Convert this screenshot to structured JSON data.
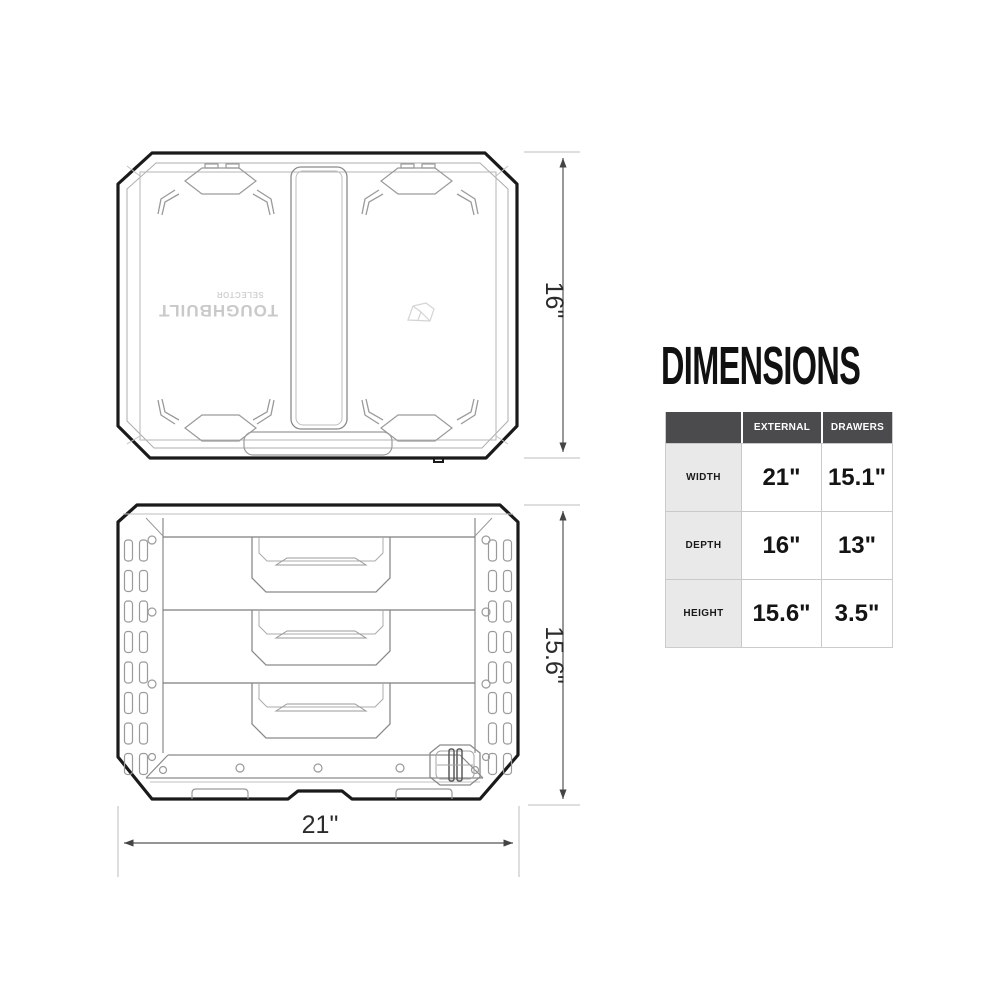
{
  "drawings": {
    "top_view": {
      "depth_dimension": "16\"",
      "brand_text": "TOUGHBUILT",
      "brand_subtext": "SELECTOR"
    },
    "front_view": {
      "height_dimension": "15.6\"",
      "width_dimension": "21\""
    }
  },
  "dimensions_panel": {
    "title": "DIMENSIONS",
    "table": {
      "column_headers": [
        "EXTERNAL",
        "DRAWERS"
      ],
      "rows": [
        {
          "label": "WIDTH",
          "external": "21\"",
          "drawers": "15.1\""
        },
        {
          "label": "DEPTH",
          "external": "16\"",
          "drawers": "13\""
        },
        {
          "label": "HEIGHT",
          "external": "15.6\"",
          "drawers": "3.5\""
        }
      ]
    }
  },
  "colors": {
    "outline": "#1a1a1a",
    "line_medium": "#8a8a8a",
    "line_light": "#b8b8b8",
    "dimension_line": "#555555",
    "header_bg": "#4b4b4d",
    "header_text": "#ffffff",
    "label_col_bg": "#e9e9ea",
    "cell_border": "#c9c9c9"
  }
}
